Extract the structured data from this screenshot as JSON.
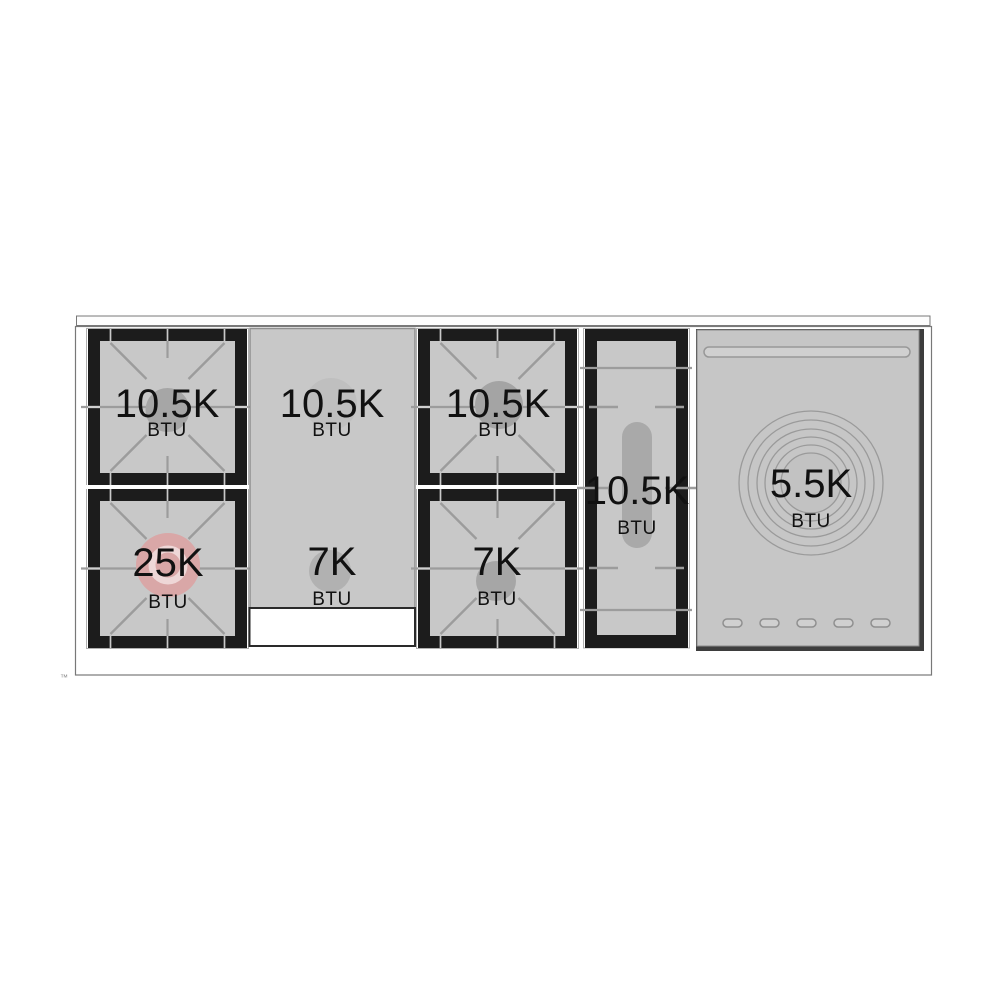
{
  "burners": {
    "left_top": {
      "value": "10.5K",
      "unit": "BTU"
    },
    "left_bottom": {
      "value": "25K",
      "unit": "BTU"
    },
    "griddle_top": {
      "value": "10.5K",
      "unit": "BTU"
    },
    "griddle_bottom": {
      "value": "7K",
      "unit": "BTU"
    },
    "center_top": {
      "value": "10.5K",
      "unit": "BTU"
    },
    "center_bottom": {
      "value": "7K",
      "unit": "BTU"
    },
    "oval": {
      "value": "10.5K",
      "unit": "BTU"
    },
    "warming_zone": {
      "value": "5.5K",
      "unit": "BTU"
    }
  },
  "trademark": "™",
  "colors": {
    "surface_gray": "#c8c8c8",
    "grate_black": "#1c1c1c",
    "line_gray": "#9c9c9c",
    "power_burner_pink": "#d9a7a7",
    "panel_gray": "#c6c6c6",
    "text": "#111111"
  }
}
